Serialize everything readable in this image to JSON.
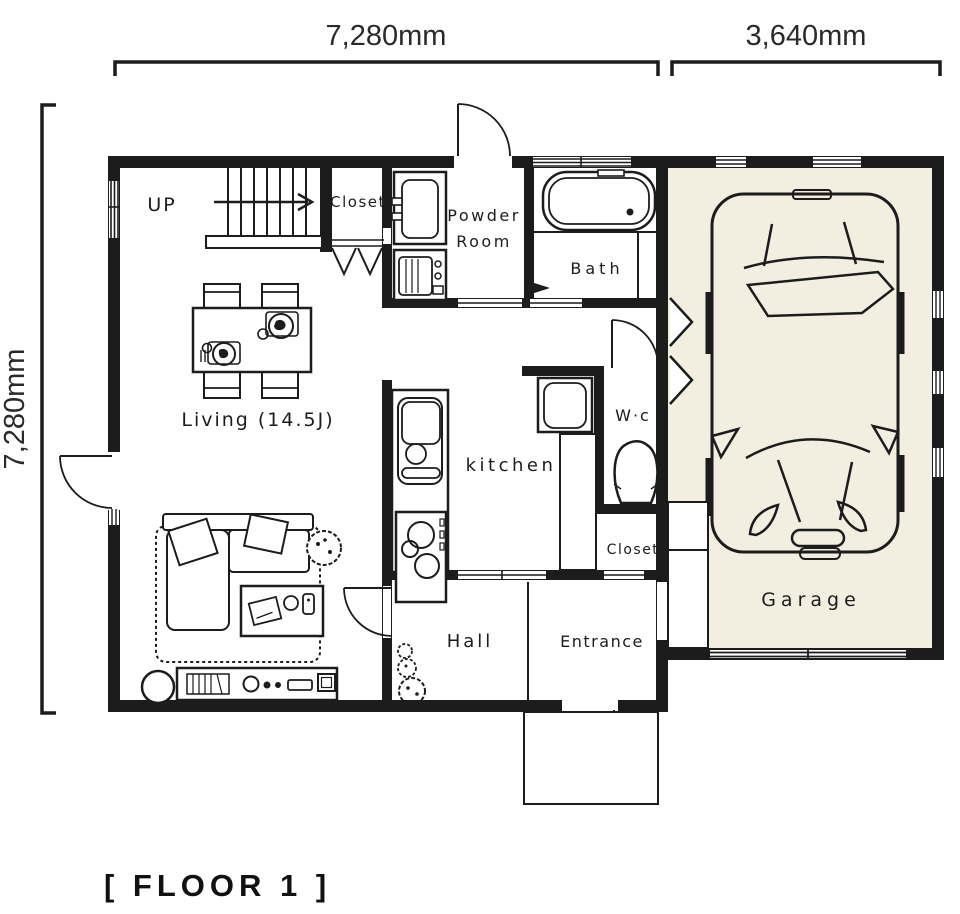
{
  "dimensions": {
    "top_main": "7,280mm",
    "top_garage": "3,640mm",
    "left": "7,280mm"
  },
  "floor_label": "[ FLOOR 1 ]",
  "rooms": {
    "stairs_direction": "UP",
    "closet_upper": "Closet",
    "powder_line1": "Powder",
    "powder_line2": "Room",
    "bath": "Bath",
    "living": "Living (14.5J)",
    "kitchen": "kitchen",
    "wc": "W·c",
    "closet_middle": "Closet",
    "hall": "Hall",
    "entrance": "Entrance",
    "garage": "Garage"
  },
  "colors": {
    "wall": "#1c1c1c",
    "garage_floor": "#f2efe0",
    "paper": "#ffffff",
    "dimension_text": "#2a2a2a"
  }
}
